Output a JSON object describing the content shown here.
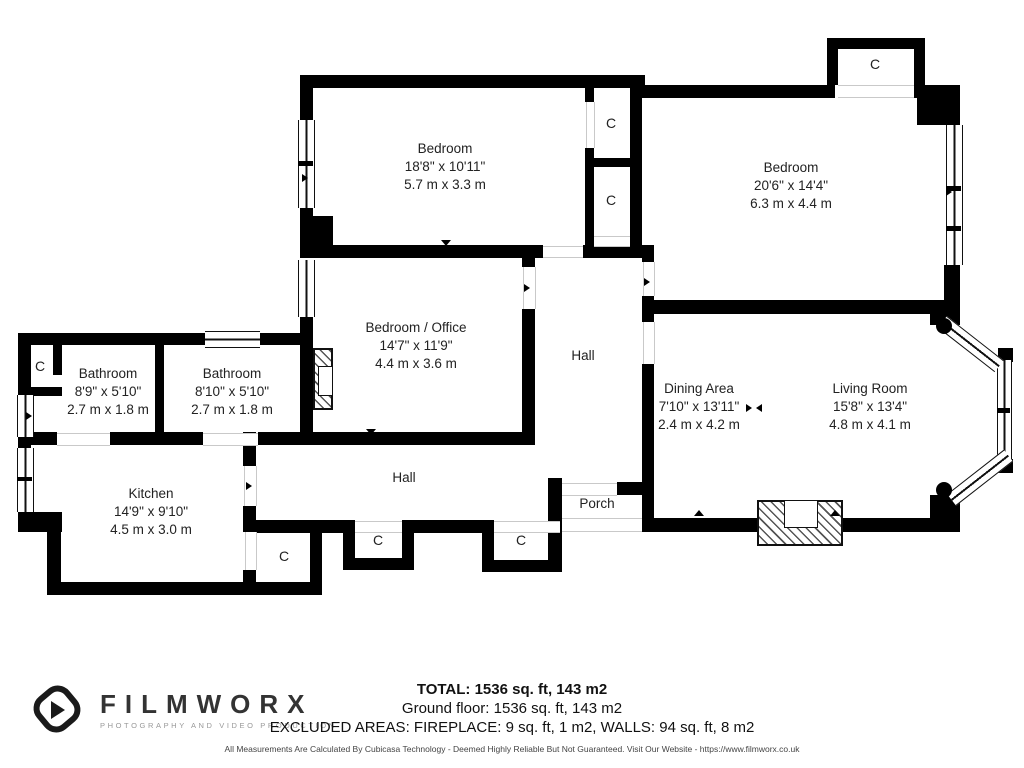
{
  "plan": {
    "closet_label": "C",
    "rooms": {
      "bedroom_top_left": {
        "name": "Bedroom",
        "imperial": "18'8\" x 10'11\"",
        "metric": "5.7 m x 3.3 m"
      },
      "bedroom_top_right": {
        "name": "Bedroom",
        "imperial": "20'6\" x 14'4\"",
        "metric": "6.3 m x 4.4 m"
      },
      "bedroom_office": {
        "name": "Bedroom / Office",
        "imperial": "14'7\" x 11'9\"",
        "metric": "4.4 m x 3.6 m"
      },
      "bathroom_left": {
        "name": "Bathroom",
        "imperial": "8'9\" x 5'10\"",
        "metric": "2.7 m x 1.8 m"
      },
      "bathroom_right": {
        "name": "Bathroom",
        "imperial": "8'10\" x 5'10\"",
        "metric": "2.7 m x 1.8 m"
      },
      "kitchen": {
        "name": "Kitchen",
        "imperial": "14'9\" x 9'10\"",
        "metric": "4.5 m x 3.0 m"
      },
      "dining_area": {
        "name": "Dining Area",
        "imperial": "7'10\" x 13'11\"",
        "metric": "2.4 m x 4.2 m"
      },
      "living_room": {
        "name": "Living Room",
        "imperial": "15'8\" x 13'4\"",
        "metric": "4.8 m x 4.1 m"
      },
      "hall_upper": {
        "name": "Hall"
      },
      "hall_lower": {
        "name": "Hall"
      },
      "porch": {
        "name": "Porch"
      }
    }
  },
  "summary": {
    "total": "TOTAL: 1536 sq. ft, 143 m2",
    "ground_floor": "Ground floor: 1536 sq. ft, 143 m2",
    "excluded_areas": "EXCLUDED AREAS: FIREPLACE: 9 sq. ft, 1 m2, WALLS: 94 sq. ft, 8 m2",
    "disclaimer": "All Measurements Are Calculated By Cubicasa Technology - Deemed Highly Reliable But Not Guaranteed. Visit Our Website - https://www.filmworx.co.uk"
  },
  "branding": {
    "name": "FILMWORX",
    "tagline": "PHOTOGRAPHY AND VIDEO PRODUCTION"
  },
  "colors": {
    "wall": "#000000",
    "text": "#222222",
    "door_line": "#c9c9c9"
  }
}
